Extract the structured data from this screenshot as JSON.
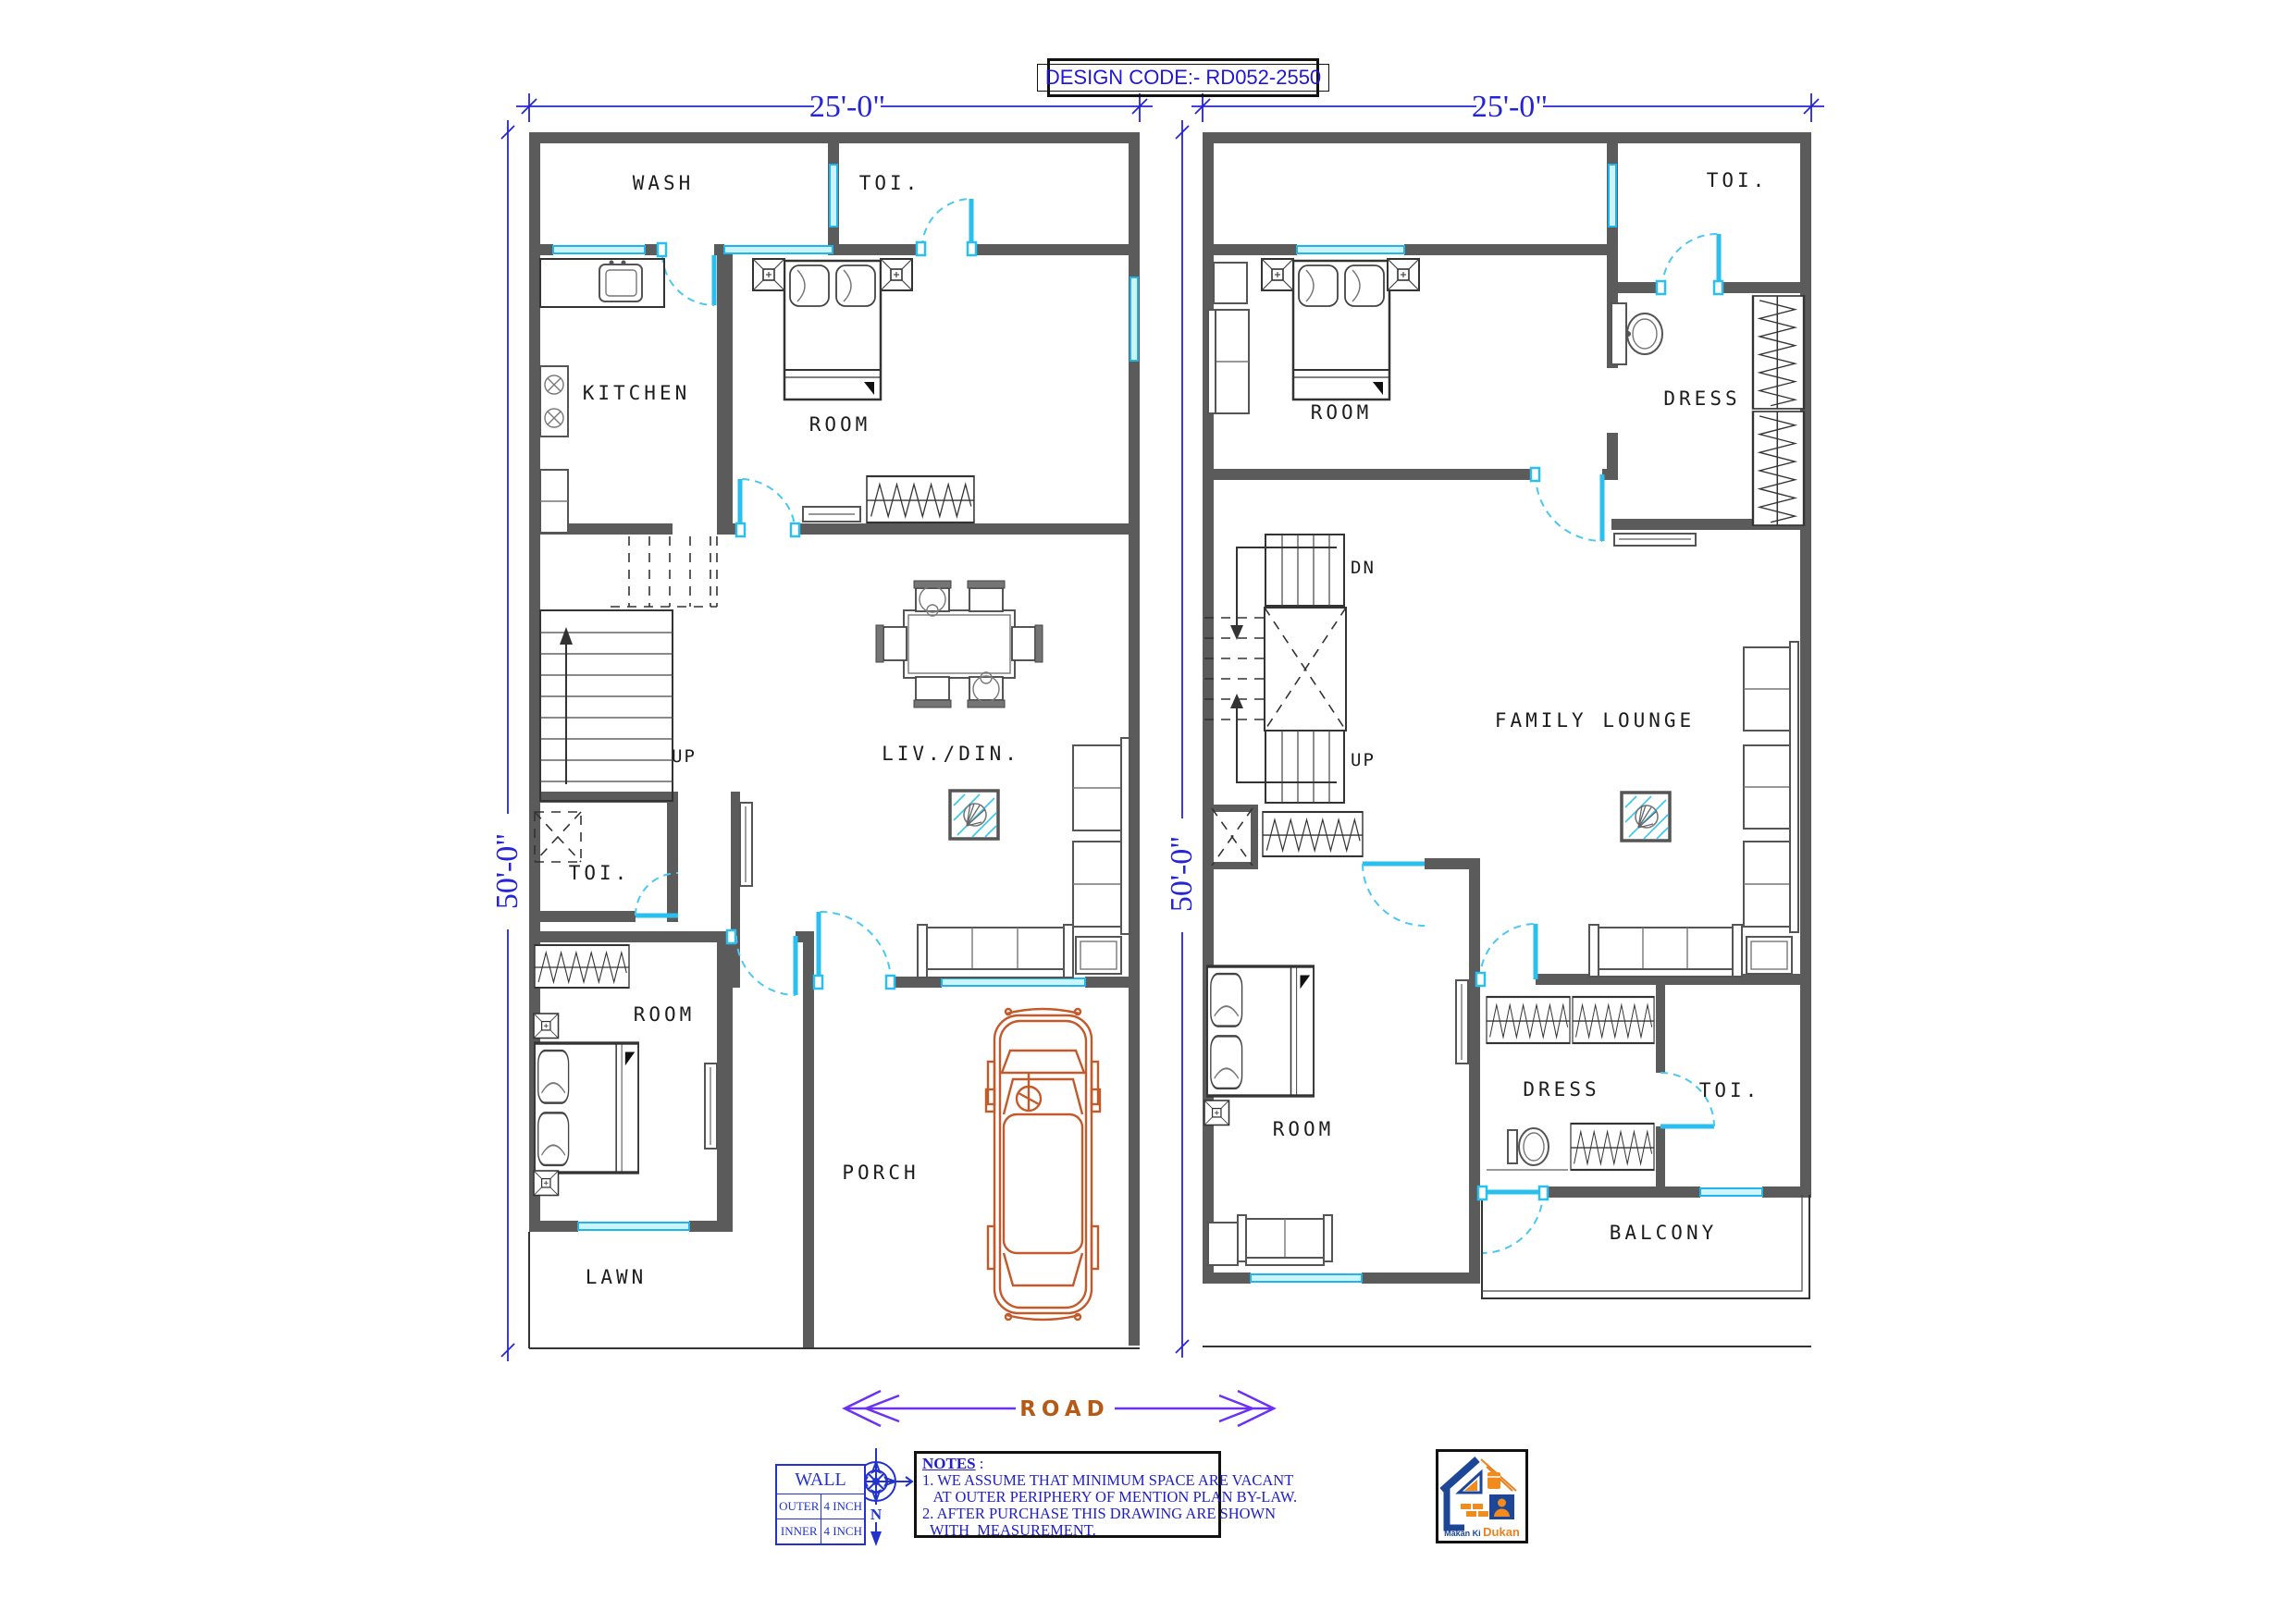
{
  "title": {
    "design_code": "DESIGN CODE:- RD052-2550"
  },
  "dims": {
    "width": "25'-0\"",
    "depth": "50'-0\""
  },
  "gf": {
    "wash": "WASH",
    "toi_top": "TOI.",
    "kitchen": "KITCHEN",
    "room_top": "ROOM",
    "up": "UP",
    "livdin": "LIV./DIN.",
    "toi_mid": "TOI.",
    "room_bottom": "ROOM",
    "porch": "PORCH",
    "lawn": "LAWN"
  },
  "ff": {
    "toi_top": "TOI.",
    "room_top": "ROOM",
    "dress_top": "DRESS",
    "dn": "DN",
    "up": "UP",
    "lounge": "FAMILY LOUNGE",
    "room_bottom": "ROOM",
    "dress_bottom": "DRESS",
    "toi_bottom": "TOI.",
    "balcony": "BALCONY"
  },
  "road": {
    "label": "ROAD"
  },
  "wall_table": {
    "title": "WALL",
    "rows": [
      {
        "label": "OUTER",
        "value": "4 INCH"
      },
      {
        "label": "INNER",
        "value": "4 INCH"
      }
    ]
  },
  "compass": {
    "north": "N"
  },
  "notes": {
    "title": "NOTES",
    "colon": " :",
    "lines": [
      "1. WE ASSUME THAT MINIMUM SPACE ARE VACANT",
      "   AT OUTER PERIPHERY OF MENTION PLAN BY-LAW.",
      "2. AFTER PURCHASE THIS DRAWING ARE SHOWN",
      "  WITH  MEASUREMENT."
    ]
  },
  "logo": {
    "makan": "Makan Ki",
    "dukan": "Dukan"
  },
  "colors": {
    "wall": "#5b5b5b",
    "opening_cyan": "#29bfee",
    "dimension_blue": "#2525d6",
    "road_text": "#b55a17",
    "road_arrow": "#6b30f2",
    "car_orange": "#c4592a",
    "notes_blue": "#2020c8",
    "title_blue": "#2016d9"
  }
}
